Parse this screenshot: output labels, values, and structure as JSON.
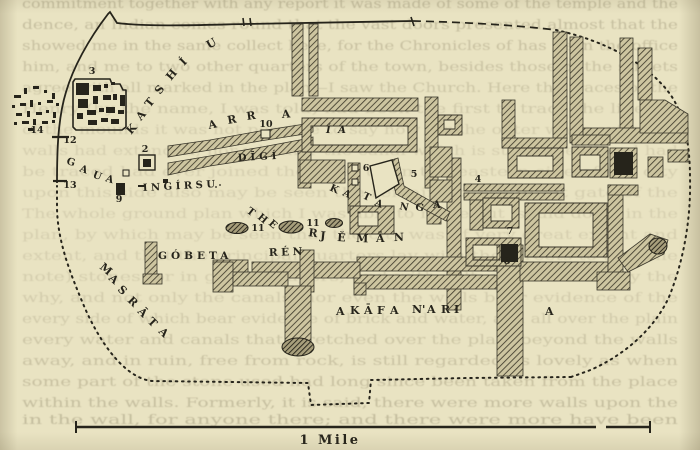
{
  "page": {
    "background": "#e9e3c2",
    "ink": "#26241b",
    "ghost_color": "#8d8468",
    "hatch_color": "#3f3b2b"
  },
  "map": {
    "place_labels": [
      {
        "id": "katshiu",
        "text": "KATSHÍU",
        "size": 11,
        "chars": [
          [
            "K",
            131,
            135,
            -48
          ],
          [
            "A",
            141,
            121,
            -50
          ],
          [
            "T",
            150,
            108,
            -52
          ],
          [
            "S",
            160,
            95,
            -52
          ],
          [
            "H",
            171,
            81,
            -50
          ],
          [
            "Í",
            184,
            66,
            -45
          ],
          [
            "U",
            209,
            49,
            -30
          ]
        ]
      },
      {
        "id": "arra",
        "text": "ARRA",
        "size": 11,
        "chars": [
          [
            "A",
            209,
            129,
            -12
          ],
          [
            "R",
            228,
            124,
            -10
          ],
          [
            "R",
            247,
            120,
            -8
          ],
          [
            "A",
            282,
            118,
            -4
          ]
        ]
      },
      {
        "id": "digi",
        "text": "DĪGÍ",
        "x": 238,
        "y": 161,
        "rotate": -3,
        "spacing": 4,
        "size": 10
      },
      {
        "id": "gaua",
        "text": "GAUA",
        "size": 10,
        "chars": [
          [
            "G",
            66,
            164,
            15
          ],
          [
            "A",
            79,
            171,
            20
          ],
          [
            "U",
            92,
            177,
            22
          ],
          [
            "A",
            105,
            181,
            18
          ]
        ]
      },
      {
        "id": "ingirsu",
        "text": "INGÍRSU",
        "x": 143,
        "y": 191,
        "rotate": -3,
        "spacing": 3.5,
        "size": 10
      },
      {
        "id": "ia",
        "text": "Í A",
        "x": 326,
        "y": 133,
        "size": 10,
        "spacing": 2,
        "italic": true
      },
      {
        "id": "the",
        "text": "THE",
        "size": 10,
        "chars": [
          [
            "T",
            246,
            212,
            38
          ],
          [
            "H",
            257,
            218,
            40
          ],
          [
            "E",
            268,
            224,
            42
          ]
        ]
      },
      {
        "id": "rjeman",
        "text": "RJĔMĀN",
        "size": 11,
        "chars": [
          [
            "R",
            308,
            236,
            8
          ],
          [
            "J",
            320,
            239,
            6
          ],
          [
            "Ĕ",
            337,
            241,
            4
          ],
          [
            "M",
            356,
            242,
            2
          ],
          [
            "Ā",
            376,
            242,
            0
          ],
          [
            "N",
            394,
            241,
            -2
          ]
        ]
      },
      {
        "id": "katanga",
        "text": "KATANGA",
        "size": 10,
        "chars": [
          [
            "K",
            329,
            190,
            25
          ],
          [
            "A",
            342,
            195,
            25
          ],
          [
            "T",
            362,
            198,
            25
          ],
          [
            "A",
            374,
            205,
            22
          ],
          [
            "N",
            399,
            209,
            12
          ],
          [
            "G",
            415,
            210,
            8
          ],
          [
            "A",
            433,
            208,
            0
          ]
        ]
      },
      {
        "id": "gobeta",
        "text": "GÓBETA",
        "x": 158,
        "y": 259,
        "rotate": 0,
        "spacing": 4,
        "size": 10.5
      },
      {
        "id": "ren",
        "text": "RÉN",
        "x": 269,
        "y": 256,
        "rotate": -2,
        "spacing": 3.5,
        "size": 10.5
      },
      {
        "id": "masrata",
        "text": "MASRĀTA",
        "size": 11,
        "chars": [
          [
            "M",
            99,
            268,
            40
          ],
          [
            "A",
            108,
            279,
            42
          ],
          [
            "S",
            117,
            290,
            44
          ],
          [
            "R",
            127,
            301,
            45
          ],
          [
            "Ā",
            137,
            312,
            45
          ],
          [
            "T",
            147,
            322,
            45
          ],
          [
            "A",
            158,
            332,
            45
          ]
        ]
      },
      {
        "id": "akafa-nari",
        "text": "AKĀFA N'ARI",
        "size": 11,
        "chars": [
          [
            "A",
            336,
            315,
            0
          ],
          [
            "K",
            350,
            314,
            0
          ],
          [
            "Ā",
            364,
            314,
            0
          ],
          [
            "F",
            377,
            314,
            0
          ],
          [
            "A",
            390,
            314,
            0
          ],
          [
            "N'",
            412,
            313,
            0
          ],
          [
            "A",
            427,
            313,
            0
          ],
          [
            "R",
            441,
            313,
            0
          ],
          [
            "I",
            454,
            313,
            0
          ]
        ]
      },
      {
        "id": "aria-a",
        "text": "A",
        "x": 545,
        "y": 315,
        "size": 11
      }
    ],
    "site_numbers": [
      {
        "n": "2",
        "x": 145,
        "y": 152
      },
      {
        "n": "3",
        "x": 92,
        "y": 74
      },
      {
        "n": "4",
        "x": 478,
        "y": 182
      },
      {
        "n": "5",
        "x": 414,
        "y": 177
      },
      {
        "n": "6",
        "x": 366,
        "y": 171
      },
      {
        "n": "7",
        "x": 510,
        "y": 234
      },
      {
        "n": "8",
        "x": 507,
        "y": 264
      },
      {
        "n": "9",
        "x": 119,
        "y": 202
      },
      {
        "n": "10",
        "x": 266,
        "y": 127
      },
      {
        "n": "11",
        "x": 258,
        "y": 231
      },
      {
        "n": "11",
        "x": 313,
        "y": 226
      },
      {
        "n": "12",
        "x": 70,
        "y": 143
      },
      {
        "n": "13",
        "x": 70,
        "y": 188
      },
      {
        "n": "14",
        "x": 37,
        "y": 133
      }
    ],
    "scale_bar": {
      "label": "1 Mile"
    }
  },
  "ghost_lines": [
    {
      "y": 8,
      "o": 0.4,
      "t": "commitment together with any report it was made of some of the temple and the"
    },
    {
      "y": 29,
      "o": 0.38,
      "t": "dence, an Indian comes round that the vast doors presented almost that the"
    },
    {
      "y": 50,
      "o": 0.36,
      "t": "showed me in the same collect here, for the Chronicles of has been the office"
    },
    {
      "y": 71,
      "o": 0.33,
      "t": "him, and me to two other quarters of the town, besides those of the streets"
    },
    {
      "y": 92,
      "o": 0.3,
      "t": "agree with all marked in the plan—I saw the Church. Here the traces of the"
    },
    {
      "y": 113,
      "o": 0.26,
      "t": "Henry (by the name, I was told) had been the first to trace the lines of"
    },
    {
      "y": 134,
      "o": 0.22,
      "t": "of the mounds it was not possible to say how far the outer walls extended"
    },
    {
      "y": 155,
      "o": 0.2,
      "t": "walls had extended, nor whether the canal which is still to be traced had"
    },
    {
      "y": 176,
      "o": 0.2,
      "t": "be traced had ever joined the river upon the eastern side of the city"
    },
    {
      "y": 197,
      "o": 0.2,
      "t": "upon this side also may be seen the remains of the great gate of the"
    },
    {
      "y": 218,
      "o": 0.2,
      "t": "The whole ground plan which I was able to make out is laid down in the"
    },
    {
      "y": 239,
      "o": 0.2,
      "t": "plan, by which may be seen that the city was of very great extent and"
    },
    {
      "y": 260,
      "o": 0.2,
      "t": "extent, and that the principal quarters lay with the streets to (see the"
    },
    {
      "y": 281,
      "o": 0.22,
      "t": "note) stones, or in granite layers; and with salt, so that not only the"
    },
    {
      "y": 302,
      "o": 0.24,
      "t": "why, and not only the canals, nor even the walls bear evidence of the"
    },
    {
      "y": 323,
      "o": 0.26,
      "t": "every side of which bear evidence of brick and water, and all over the plain"
    },
    {
      "y": 344,
      "o": 0.3,
      "t": "every water and canals that stretched over the plain beyond the walls"
    },
    {
      "y": 365,
      "o": 0.33,
      "t": "away, and in ruin, free from rock, is still regarded as lovely as when"
    },
    {
      "y": 386,
      "o": 0.36,
      "t": "some part of the stone used had long since been taken from the place"
    },
    {
      "y": 407,
      "o": 0.38,
      "t": "within the walls. Formerly, it is said, there were more walls upon the"
    },
    {
      "y": 424,
      "o": 0.4,
      "t": "in the wall, for anyone there; and there were more have been"
    }
  ]
}
